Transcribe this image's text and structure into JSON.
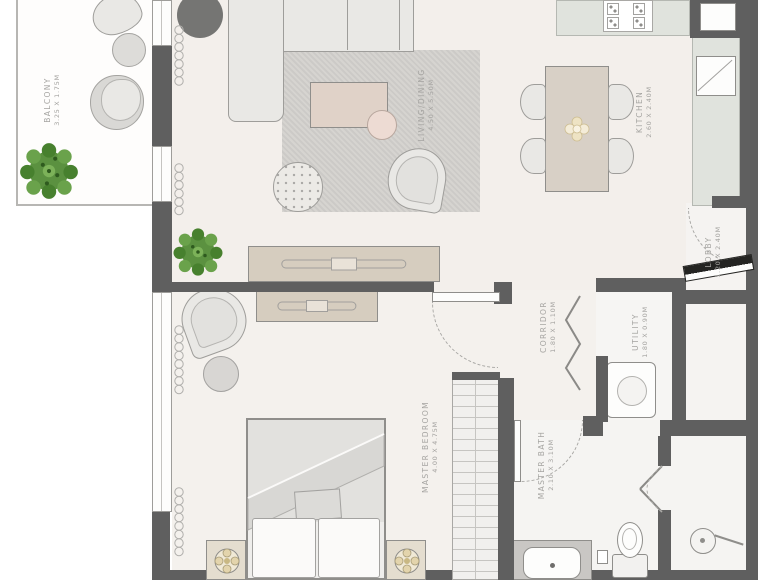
{
  "rooms": [
    {
      "name": "BALCONY",
      "dims": "3.25 X 1.75M"
    },
    {
      "name": "LIVING/DINING",
      "dims": "4.50 X 5.50M"
    },
    {
      "name": "KITCHEN",
      "dims": "2.60 X 2.40M"
    },
    {
      "name": "LOBBY",
      "dims": "1.20 X 2.40M"
    },
    {
      "name": "CORRIDOR",
      "dims": "1.80 X 1.10M"
    },
    {
      "name": "UTILITY",
      "dims": "1.80 X 0.90M"
    },
    {
      "name": "MASTER BEDROOM",
      "dims": "4.00 X 4.75M"
    },
    {
      "name": "MASTER BATH",
      "dims": "2.10 X 3.10M"
    }
  ],
  "colors": {
    "wall": "#5f5f5f",
    "floor": "#f3efeb",
    "rug": "#d3d1cd",
    "counter": "#e0e3dd",
    "wood_furniture": "#d6cdbf",
    "plant_green": "#5b9140",
    "label_text": "#a5a4a1",
    "entry_door": "#242422"
  },
  "furniture": [
    "lounge-chairs",
    "balcony-table",
    "planters",
    "l-shaped-sofa",
    "area-rug",
    "coffee-table",
    "side-table",
    "pouf",
    "accent-chair",
    "tv-console",
    "dining-table",
    "dining-chairs",
    "stove",
    "kitchen-sink",
    "fridge-niche",
    "entrance-door",
    "bifold-doors",
    "washer",
    "dresser",
    "armchair",
    "ottoman",
    "double-bed",
    "pillows",
    "nightstands",
    "table-lamps",
    "wardrobe-shelves",
    "vanity-sink",
    "toilet",
    "shower-head",
    "shower-doors"
  ]
}
